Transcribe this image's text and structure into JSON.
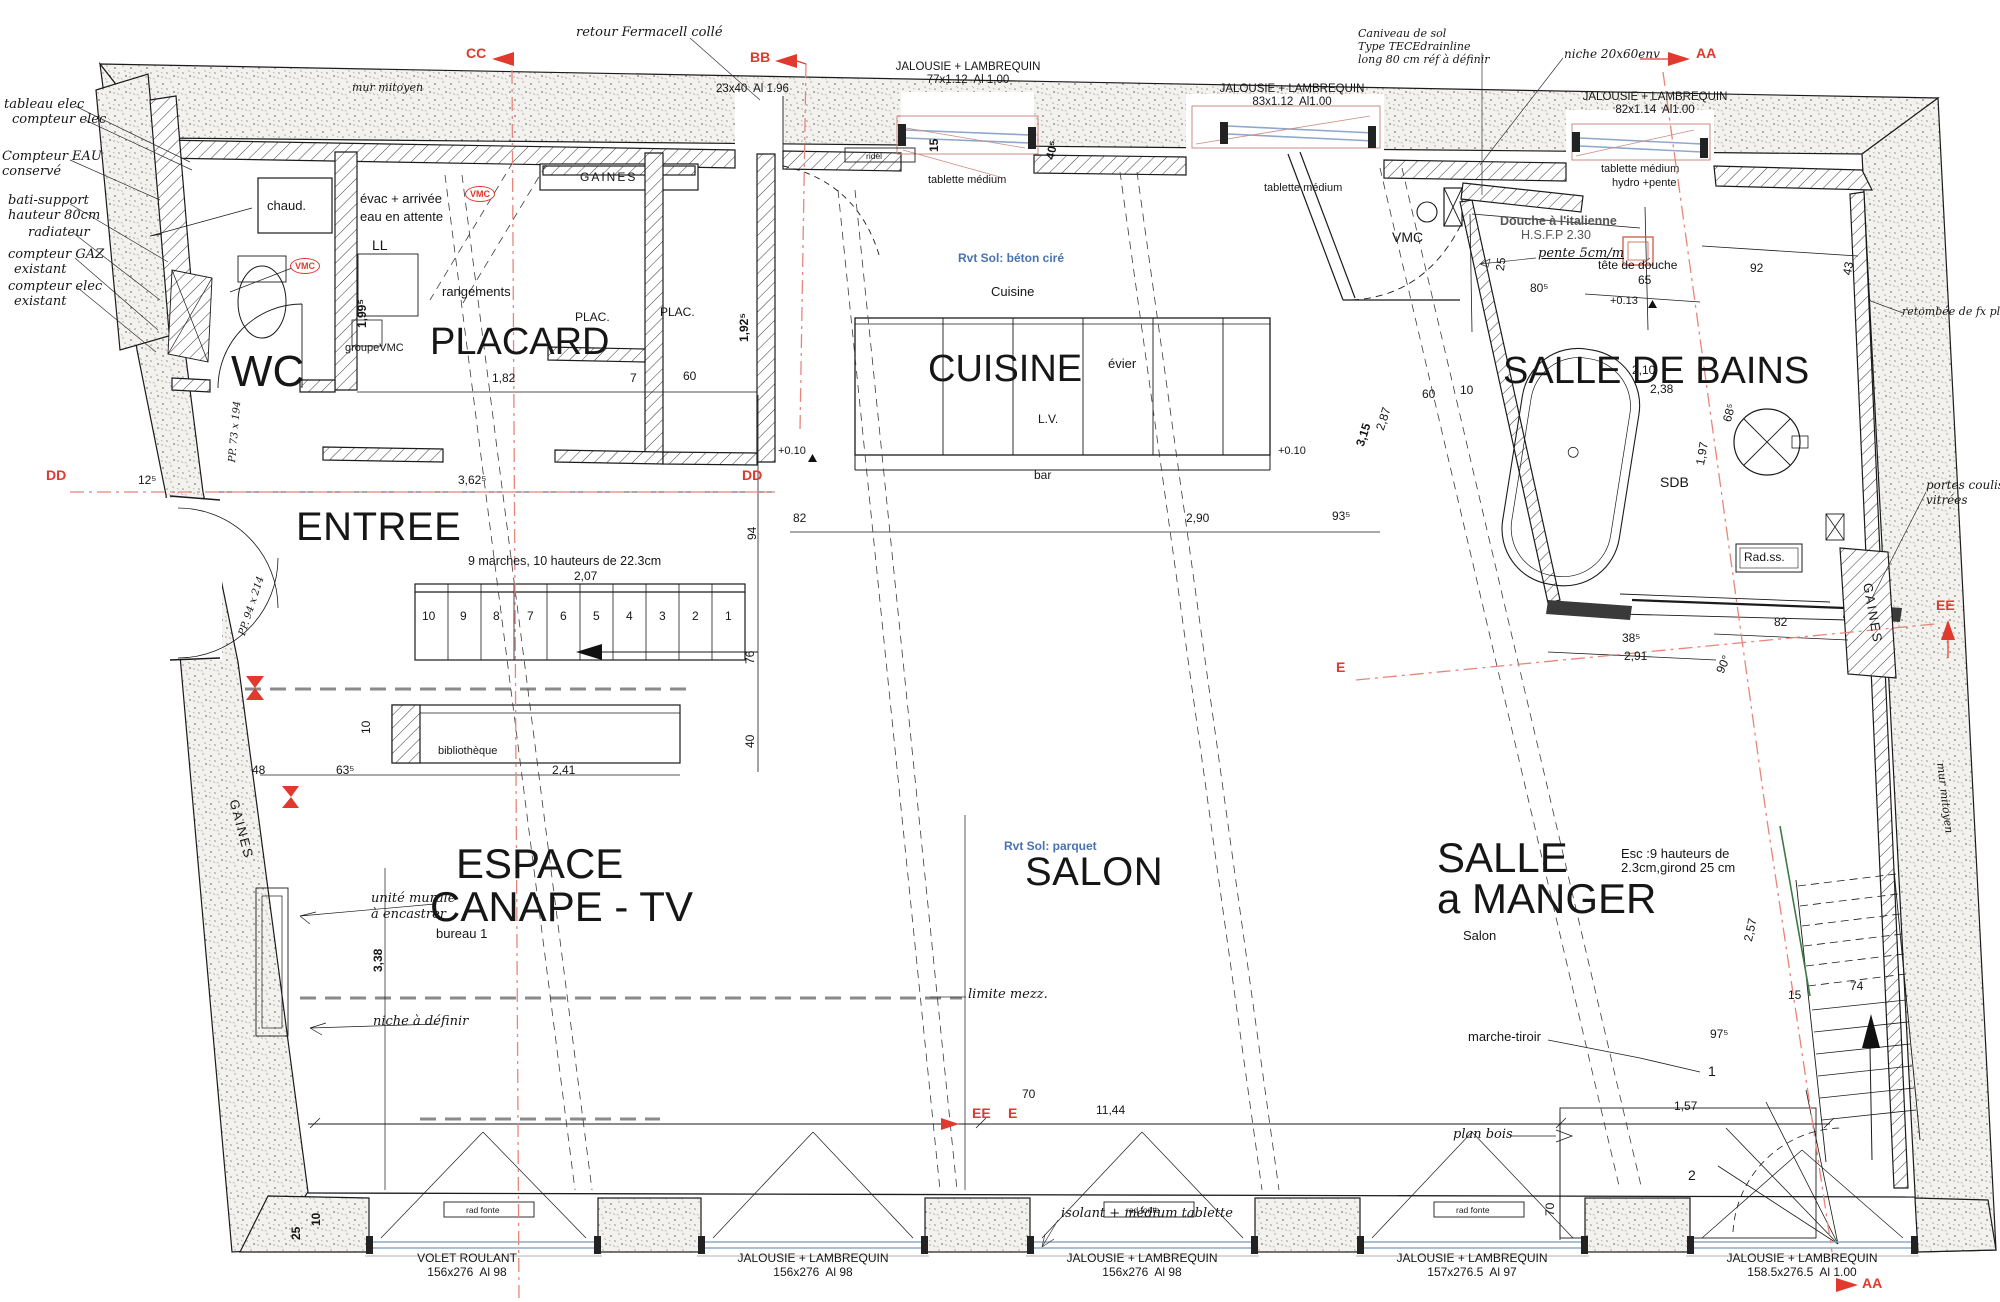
{
  "plan": {
    "markers": {
      "aa": "AA",
      "bb": "BB",
      "cc": "CC",
      "dd": "DD",
      "ee": "EE",
      "e": "E"
    },
    "rooms": {
      "wc": "WC",
      "entree": "ENTREE",
      "placard": "PLACARD",
      "cuisine": "CUISINE",
      "sdb": "SALLE DE BAINS",
      "espace": "ESPACE",
      "canape": "CANAPE - TV",
      "salon": "SALON",
      "salle": "SALLE",
      "a_manger": "a MANGER"
    },
    "small": {
      "cuisine": "Cuisine",
      "salon": "Salon",
      "sdb": "SDB",
      "vmc": "VMC",
      "chaud": "chaud.",
      "ll": "LL",
      "rangements": "rangements",
      "groupe_vmc": "groupeVMC",
      "plac": "PLAC.",
      "evier": "évier",
      "lv": "L.V.",
      "bar": "bar",
      "ridel": "ridel",
      "bibliotheque": "bibliothèque",
      "rad_ss": "Rad.ss.",
      "marche_tiroir": "marche-tiroir",
      "plan_bois": "plan bois",
      "rad_fonte": "rad fonte",
      "gaines": "GAINES",
      "tablette": "tablette médium",
      "hydro": "hydro +pente",
      "bureau": "bureau 1"
    },
    "annotations": {
      "mur_mitoyen": "mur mitoyen",
      "tableau_elec": "tableau elec",
      "compteur_elec": "compteur elec",
      "eau1": "Compteur EAU",
      "eau2": "conservé",
      "bati1": "bati-support",
      "bati2": "hauteur 80cm",
      "radiateur": "radiateur",
      "gaz": "compteur GAZ",
      "existant": "existant",
      "fermacell": "retour Fermacell collé",
      "caniveau1": "Caniveau de sol",
      "caniveau2": "Type TECEdrainline",
      "caniveau3": "long 80 cm réf à définir",
      "niche2060": "niche 20x60env",
      "douche1": "Douche à l'italienne",
      "douche2": "H.S.F.P 2.30",
      "pente": "pente 5cm/m",
      "tete": "tête de douche",
      "retombee": "retombée de fx pld",
      "portes1": "portes coulis",
      "portes2": "vitrées",
      "marches": "9 marches, 10 hauteurs de 22.3cm",
      "esc1": "Esc :9 hauteurs de",
      "esc2": "2.3cm,girond 25 cm",
      "unite1": "unité murale",
      "unite2": "à encastrer",
      "niche_def": "niche à définir",
      "limite": "limite mezz.",
      "isolant": "isolant + médium tablette",
      "rvt_beton": "Rvt Sol: béton ciré",
      "rvt_parquet": "Rvt Sol: parquet",
      "evac1": "évac + arrivée",
      "evac2": "eau en attente",
      "pp1": "PP. 73 x 194",
      "pp2": "PP. 94 x 214"
    },
    "windows_top": {
      "jalousie": "JALOUSIE + LAMBREQUIN",
      "w1": "77x1.12  Al 1.00",
      "w2": "83x1.12  Al1.00",
      "w3": "82x1.14  Al1.00",
      "beam": "23x40  Al 1.96"
    },
    "windows_bottom": {
      "volet": "VOLET ROULANT",
      "s1": "156x276  Al 98",
      "s4": "157x276.5  Al 97",
      "s5": "158.5x276.5  Al 1.00"
    },
    "stairs": [
      "10",
      "9",
      "8",
      "7",
      "6",
      "5",
      "4",
      "3",
      "2",
      "1"
    ],
    "levels": {
      "p010": "+0.10",
      "p013": "+0.13"
    },
    "dims": {
      "d182": "1,82",
      "d7": "7",
      "d60": "60",
      "d10": "10",
      "d1925": "1,92⁵",
      "d1995": "1,99⁵",
      "d3625": "3,62⁵",
      "d125": "12⁵",
      "d94": "94",
      "d76": "76",
      "d40": "40",
      "d207": "2,07",
      "d241": "2,41",
      "d635": "63⁵",
      "d48": "48",
      "d338": "3,38",
      "d82": "82",
      "d290": "2,90",
      "d935": "93⁵",
      "d287": "2,87",
      "d315": "3,15",
      "d805": "80⁵",
      "d65": "65",
      "d92": "92",
      "d25": "25",
      "d43": "43",
      "d210": "2,10",
      "d238": "2,38",
      "d197": "1,97",
      "d685": "68⁵",
      "d90": "90°",
      "d385": "38⁵",
      "d291": "2,91",
      "d1144": "11,44",
      "d70": "70",
      "d157": "1,57",
      "d975": "97⁵",
      "d74": "74",
      "d15": "15",
      "d257": "2,57",
      "d1": "1",
      "d2": "2",
      "d405": "40⁵"
    }
  }
}
